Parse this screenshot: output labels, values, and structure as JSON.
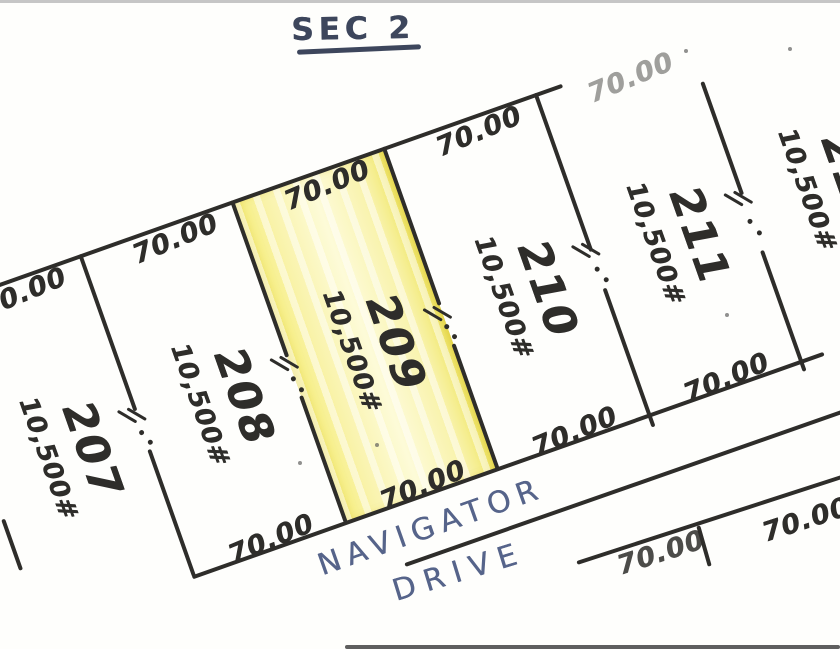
{
  "title": "SEC 2",
  "street": {
    "line1": "NAVIGATOR",
    "line2": "DRIVE"
  },
  "lots": [
    {
      "number": "207",
      "area": "10,500#",
      "top_dim": "70.00"
    },
    {
      "number": "208",
      "area": "10,500#",
      "top_dim": "70.00",
      "bottom_dim": "70.00"
    },
    {
      "number": "209",
      "area": "10,500#",
      "top_dim": "70.00",
      "bottom_dim": "70.00",
      "highlighted": true
    },
    {
      "number": "210",
      "area": "10,500#",
      "top_dim": "70.00",
      "bottom_dim": "70.00"
    },
    {
      "number": "211",
      "area": "10,500#",
      "top_dim": "70.00",
      "bottom_dim": "70.00"
    },
    {
      "number": "212",
      "area": "10,500#"
    }
  ],
  "south_block": {
    "dim_left": "70.00",
    "dim_right": "70.00"
  },
  "colors": {
    "ink": "#2e2d2a",
    "street_ink": "#56648a",
    "title_ink": "#3d465c",
    "highlight": "#f6ee7d",
    "highlight_light": "#fdfbd8",
    "paper": "#fefefc",
    "scan_edge_top": "#c6c6c6",
    "scan_edge_bottom": "#5f5f5f"
  }
}
